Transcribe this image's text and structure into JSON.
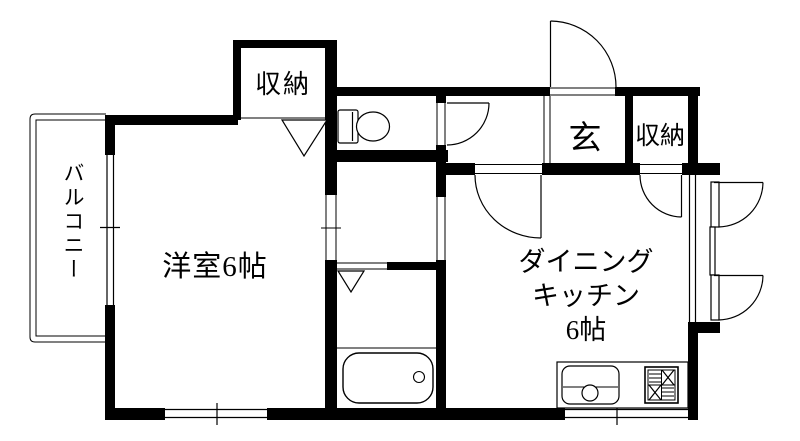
{
  "document": {
    "type": "apartment-floor-plan"
  },
  "colors": {
    "ink": "#000000",
    "paper": "#ffffff"
  },
  "labels": {
    "balcony": "バルコニー",
    "western_room": "洋室6帖",
    "dk_line1": "ダイニング",
    "dk_line2": "キッチン",
    "dk_line3": "6帖",
    "entrance": "玄",
    "storage_top": "収納",
    "storage_entry": "収納"
  },
  "fixtures": {
    "toilet": "toilet-icon",
    "bathtub": "bathtub-icon",
    "kitchen_sink": "kitchen-sink-icon",
    "gas_stove": "gas-stove-icon",
    "entry_door": "entry-door-arc",
    "toilet_door": "toilet-door-arc",
    "hall_door": "hall-door-arc",
    "storage_door": "storage-door-arc",
    "casement_windows": "casement-window-arcs",
    "folding_doors": "folding-door-triangles"
  }
}
